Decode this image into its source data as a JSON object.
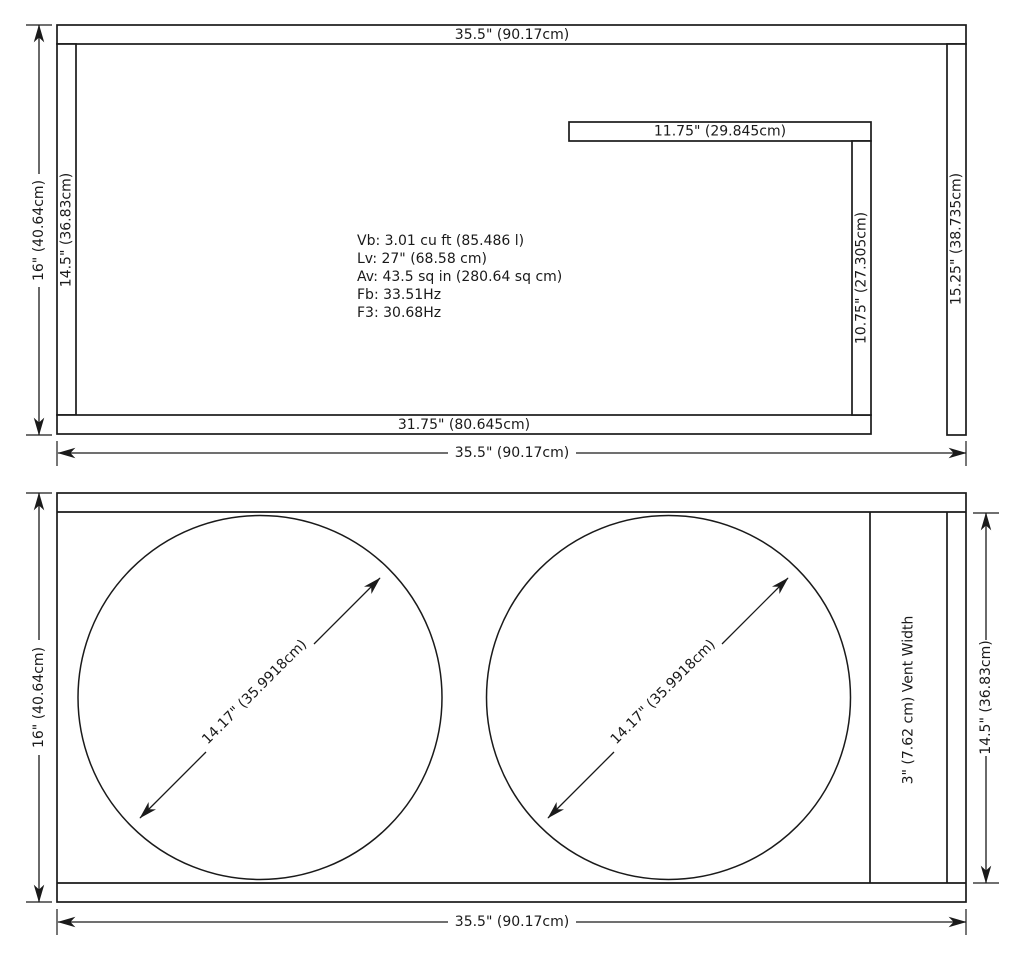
{
  "colors": {
    "line": "#1a1a1a",
    "background": "#ffffff"
  },
  "top_view": {
    "outer_width_label": "35.5\" (90.17cm)",
    "left_wall_label": "14.5\" (36.83cm)",
    "right_wall_label": "15.25\" (38.735cm)",
    "bottom_wall_label": "31.75\" (80.645cm)",
    "port_shelf_label": "11.75\" (29.845cm)",
    "port_wall_label": "10.75\" (27.305cm)",
    "height_dimension": "16\" (40.64cm)",
    "width_dimension": "35.5\" (90.17cm)",
    "specs": [
      "Vb: 3.01 cu ft (85.486 l)",
      "Lv: 27\" (68.58 cm)",
      "Av: 43.5 sq in (280.64 sq cm)",
      "Fb: 33.51Hz",
      "F3: 30.68Hz"
    ]
  },
  "front_view": {
    "height_dimension": "16\" (40.64cm)",
    "inner_height_dimension": "14.5\" (36.83cm)",
    "width_dimension": "35.5\" (90.17cm)",
    "vent_width_label": "3\" (7.62 cm) Vent Width",
    "driver_cutout_1_label": "14.17\" (35.9918cm)",
    "driver_cutout_2_label": "14.17\" (35.9918cm)"
  }
}
